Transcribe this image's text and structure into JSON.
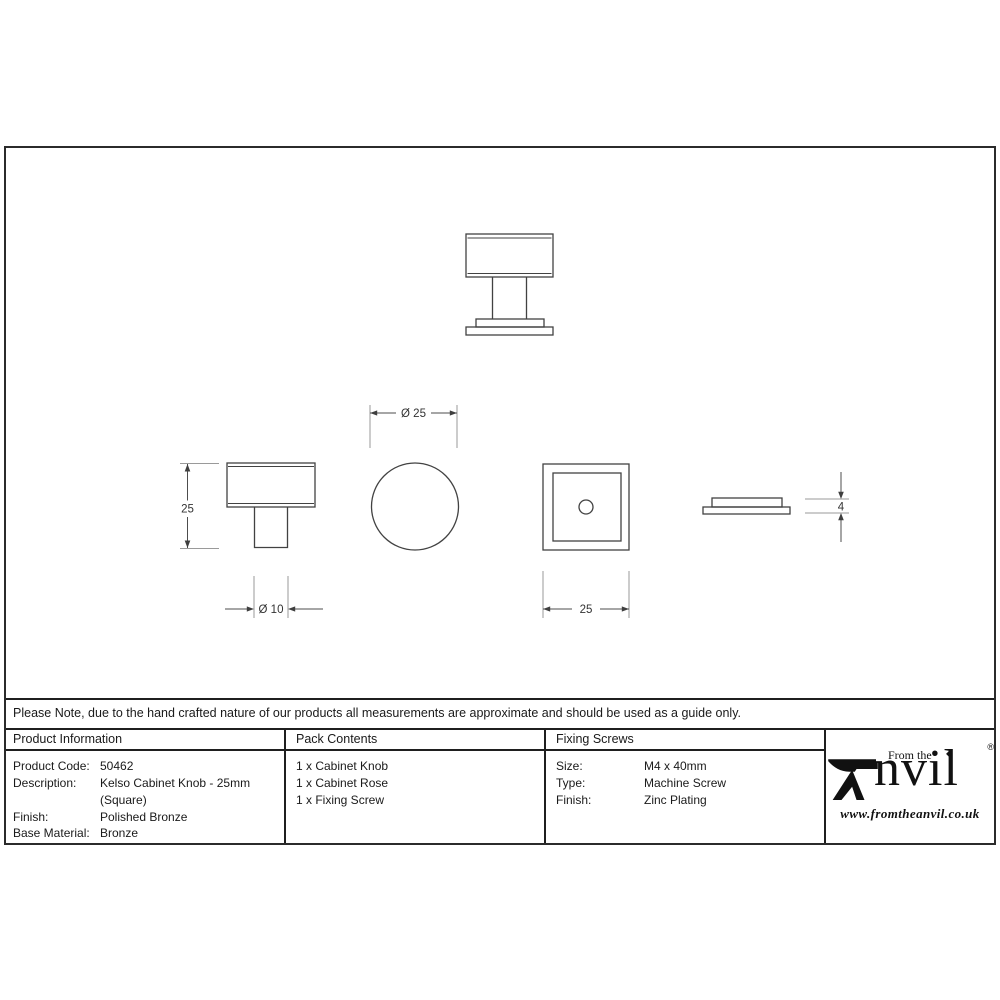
{
  "colors": {
    "ink": "#1f1f1f",
    "line_gray": "#9a9a9a"
  },
  "drawing": {
    "dim_knob_diameter": "Ø 25",
    "dim_overall_height": "25",
    "dim_stem_diameter": "Ø 10",
    "dim_rose_width": "25",
    "dim_rose_thickness": "4"
  },
  "note": "Please Note, due to the hand crafted nature of our products all measurements are approximate and should be used as a guide only.",
  "product_information": {
    "header": "Product Information",
    "product_code_label": "Product Code:",
    "product_code": "50462",
    "description_label": "Description:",
    "description_line1": "Kelso Cabinet Knob - 25mm",
    "description_line2": "(Square)",
    "finish_label": "Finish:",
    "finish": "Polished Bronze",
    "base_material_label": "Base Material:",
    "base_material": "Bronze"
  },
  "pack_contents": {
    "header": "Pack Contents",
    "items": [
      "1 x Cabinet Knob",
      "1 x Cabinet Rose",
      "1 x Fixing Screw"
    ]
  },
  "fixing_screws": {
    "header": "Fixing Screws",
    "size_label": "Size:",
    "size": "M4 x 40mm",
    "type_label": "Type:",
    "type": "Machine Screw",
    "finish_label": "Finish:",
    "finish": "Zinc Plating"
  },
  "logo": {
    "tagline": "From the",
    "name_rest": "nvil",
    "registered": "®",
    "diamond": "◆",
    "website": "www.fromtheanvil.co.uk"
  }
}
